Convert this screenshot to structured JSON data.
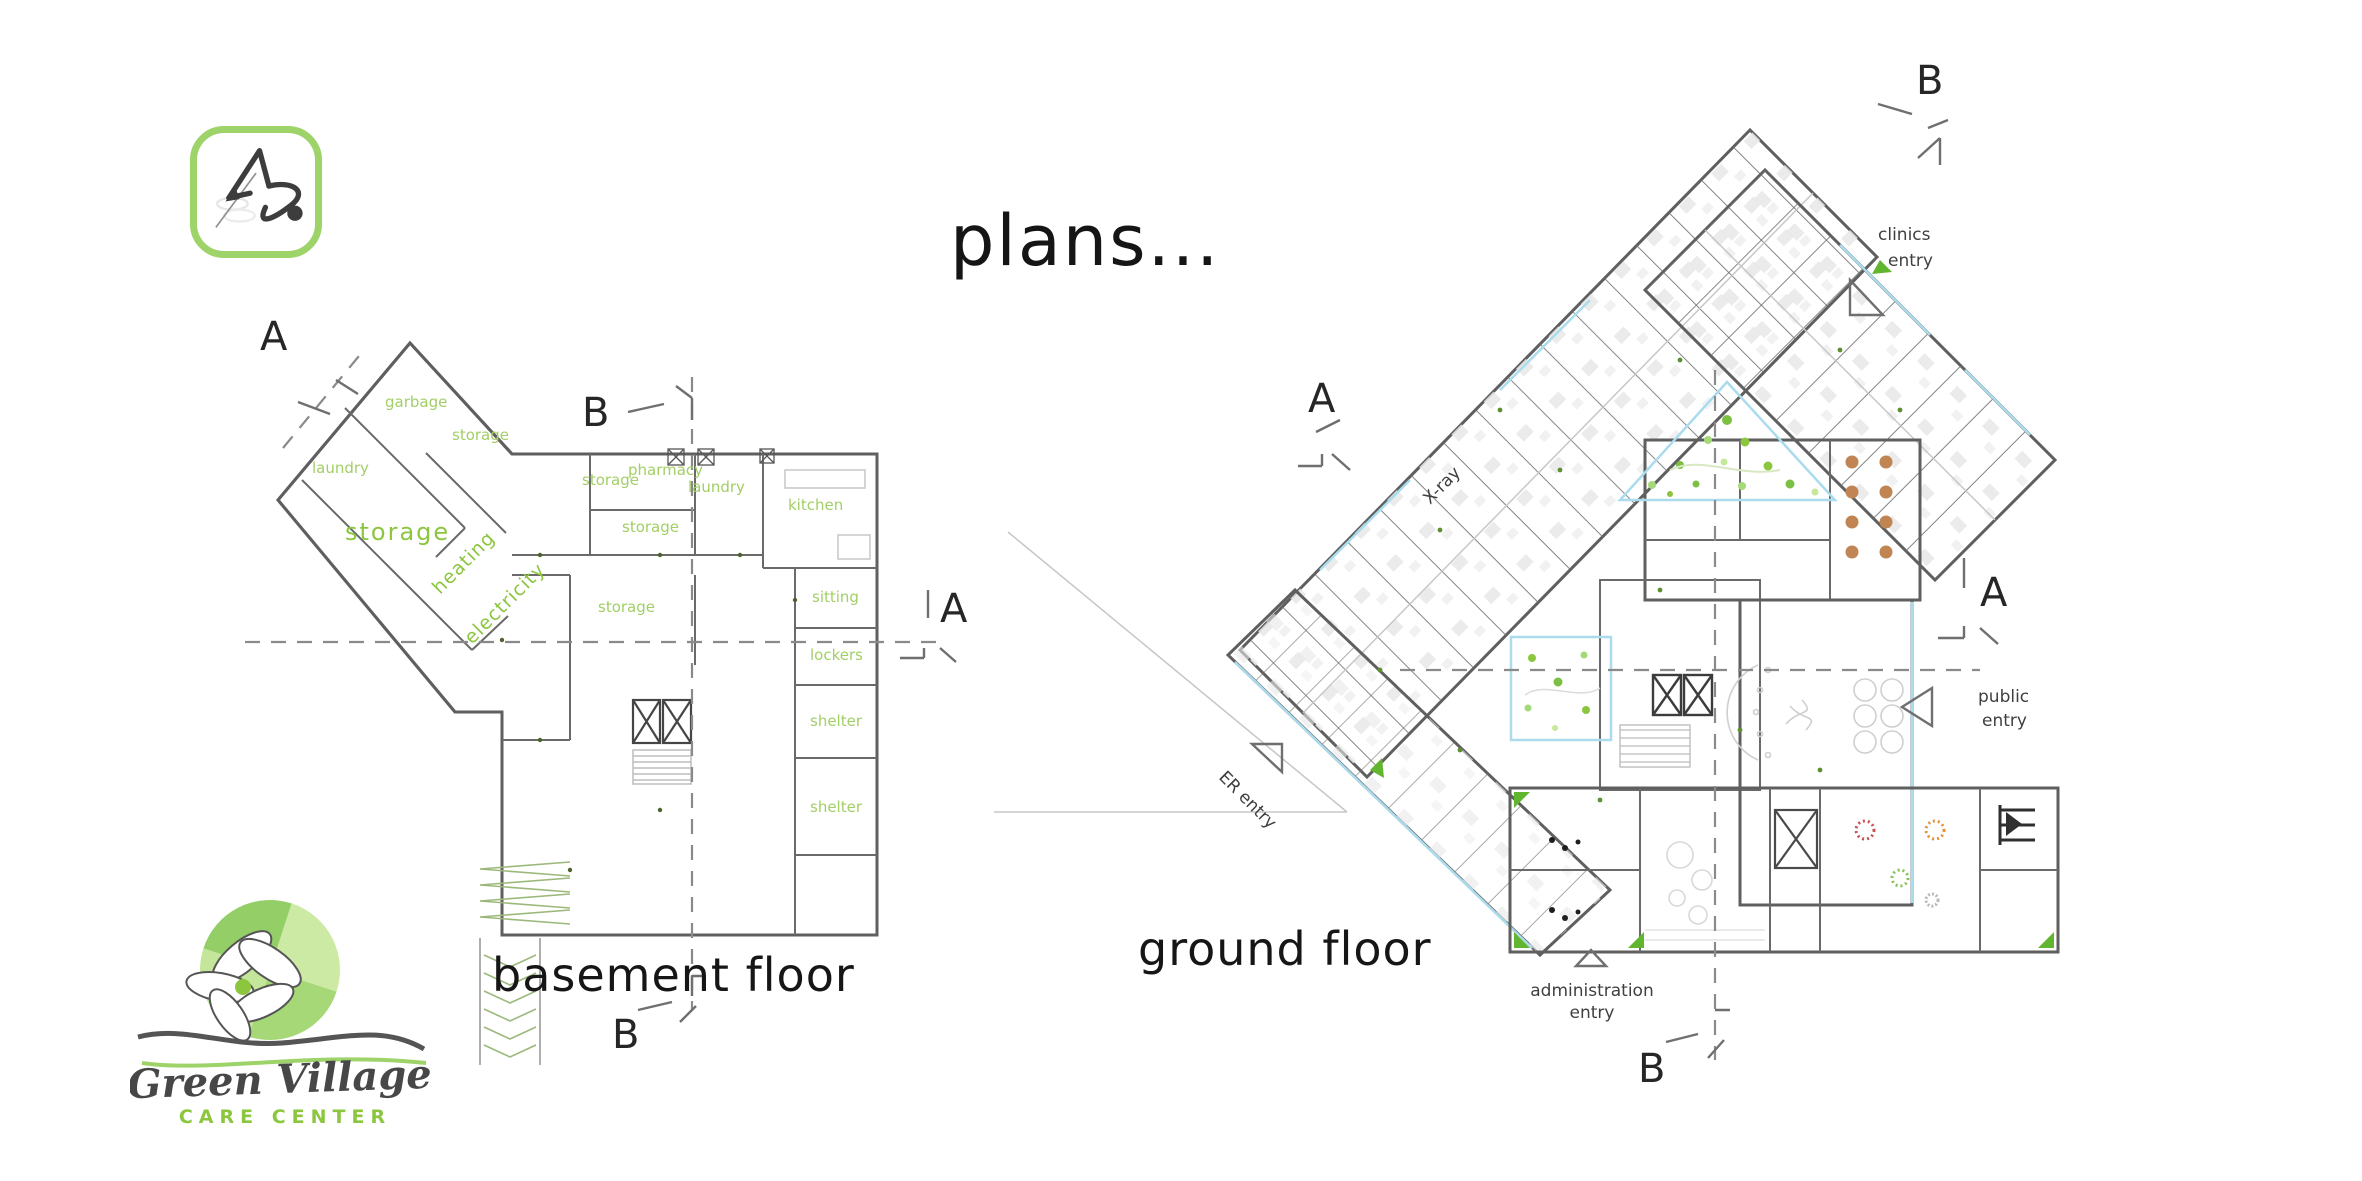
{
  "title": "plans...",
  "captions": {
    "basement": "basement floor",
    "ground": "ground floor"
  },
  "markers": {
    "a": "A",
    "b": "B"
  },
  "basement": {
    "rooms": [
      "garbage",
      "storage",
      "laundry",
      "storage",
      "heating",
      "electricity",
      "storage",
      "pharmacy",
      "laundry",
      "storage",
      "kitchen",
      "sitting",
      "storage",
      "lockers",
      "shelter",
      "shelter"
    ]
  },
  "ground": {
    "xray": "X-ray",
    "er_entry": "ER entry",
    "public_entry": [
      "public",
      "entry"
    ],
    "clinics_entry": [
      "clinics",
      "entry"
    ],
    "admin_entry": [
      "administration",
      "entry"
    ]
  },
  "brand": {
    "name": "Green Village",
    "tagline": "CARE CENTER"
  },
  "icons": {
    "app_logo": "stethoscope-compass-icon",
    "brand_logo": "flower-pinwheel-icon",
    "entry_arrow": "triangle-arrow-icon",
    "section_cut": "section-cut-icon"
  },
  "colors": {
    "logo_border_green": "#9ed36a",
    "label_green": "#a2cf66",
    "accent_green": "#8cc63f",
    "wall_gray": "#5f5f5f",
    "glass_blue": "#aadcee",
    "dash_gray": "#8a8a8a",
    "ink": "#1f1f1f"
  }
}
